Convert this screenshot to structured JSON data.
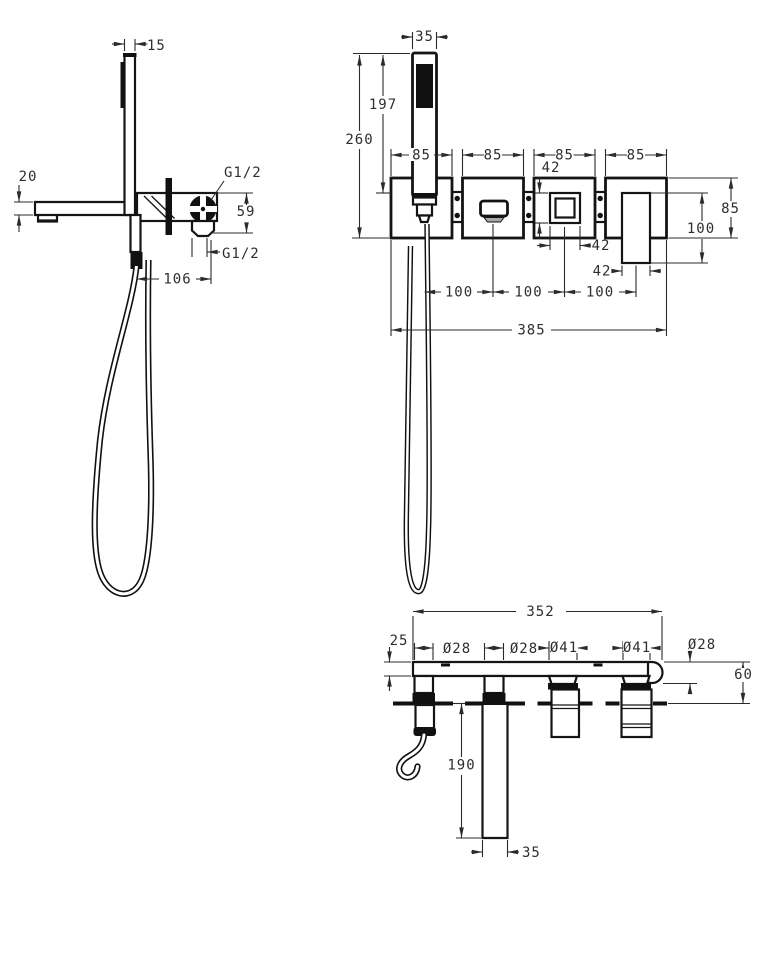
{
  "document_type": "technical-dimension-drawing",
  "subject": "wall-mounted bath shower mixer with hand shower",
  "colors": {
    "line": "#141414",
    "dim_text": "#2e2e2e",
    "solid_fill": "#111111",
    "background": "#ffffff"
  },
  "views": {
    "side": {
      "name": "side view",
      "dims": {
        "wand_width": "15",
        "spout_thickness": "20",
        "thread_top": "G1/2",
        "body_height": "59",
        "thread_bottom": "G1/2",
        "offset": "106"
      }
    },
    "front": {
      "name": "front view",
      "dims": {
        "handshower_width": "35",
        "handshower_length": "197",
        "overall_height": "260",
        "plate1_width": "85",
        "plate2_width": "85",
        "plate3_width": "85",
        "plate4_width": "85",
        "button_height": "42",
        "button_width": "42",
        "plate_height": "85",
        "handle_length": "100",
        "handle_width": "42",
        "pitch1": "100",
        "pitch2": "100",
        "pitch3": "100",
        "overall_width": "385"
      }
    },
    "bottom": {
      "name": "bottom view",
      "dims": {
        "overall_width": "352",
        "plate_thickness": "25",
        "dia_holder": "Ø28",
        "dia_spout": "Ø28",
        "dia_diverter": "Ø41",
        "dia_mixer": "Ø41",
        "dia_end": "Ø28",
        "depth": "60",
        "spout_length": "190",
        "spout_width": "35"
      }
    }
  }
}
